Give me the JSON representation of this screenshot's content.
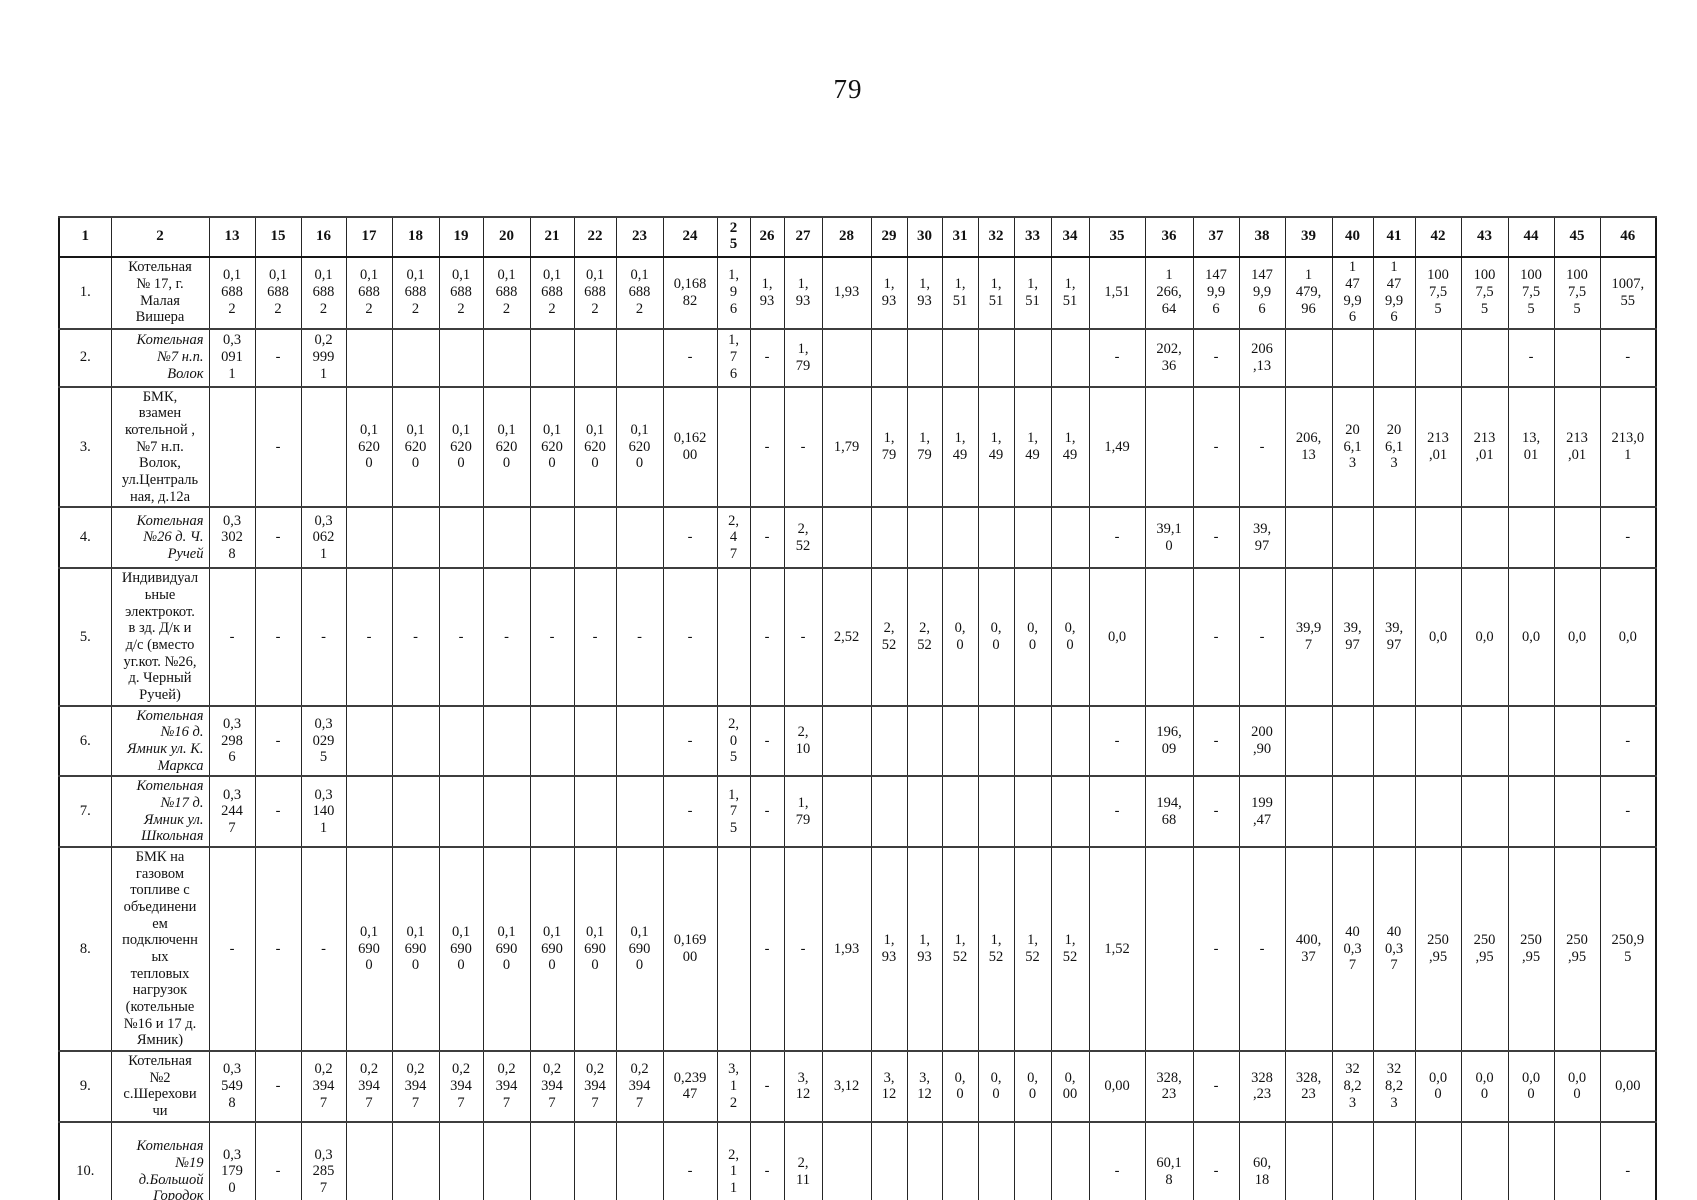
{
  "page": {
    "number": "79"
  },
  "table": {
    "header": [
      "1",
      "2",
      "13",
      "15",
      "16",
      "17",
      "18",
      "19",
      "20",
      "21",
      "22",
      "23",
      "24",
      "2\n5",
      "26",
      "27",
      "28",
      "29",
      "30",
      "31",
      "32",
      "33",
      "34",
      "35",
      "36",
      "37",
      "38",
      "39",
      "40",
      "41",
      "42",
      "43",
      "44",
      "45",
      "46"
    ],
    "rows": [
      {
        "num": "1.",
        "italic": false,
        "name": "Котельная\n№ 17, г.\nМалая\nВишера",
        "values": {
          "13": "0,1\n688\n2",
          "15": "0,1\n688\n2",
          "16": "0,1\n688\n2",
          "17": "0,1\n688\n2",
          "18": "0,1\n688\n2",
          "19": "0,1\n688\n2",
          "20": "0,1\n688\n2",
          "21": "0,1\n688\n2",
          "22": "0,1\n688\n2",
          "23": "0,1\n688\n2",
          "24": "0,168\n82",
          "25": "1,\n9\n6",
          "26": "1,\n93",
          "27": "1,\n93",
          "28": "1,93",
          "29": "1,\n93",
          "30": "1,\n93",
          "31": "1,\n51",
          "32": "1,\n51",
          "33": "1,\n51",
          "34": "1,\n51",
          "35": "1,51",
          "36": "1\n266,\n64",
          "37": "147\n9,9\n6",
          "38": "147\n9,9\n6",
          "39": "1\n479,\n96",
          "40": "1\n47\n9,9\n6",
          "41": "1\n47\n9,9\n6",
          "42": "100\n7,5\n5",
          "43": "100\n7,5\n5",
          "44": "100\n7,5\n5",
          "45": "100\n7,5\n5",
          "46": "1007,\n55"
        }
      },
      {
        "num": "2.",
        "italic": true,
        "name": "Котельная\n№7   н.п.\nВолок",
        "values": {
          "13": "0,3\n091\n1",
          "15": "-",
          "16": "0,2\n999\n1",
          "24": "-",
          "25": "1,\n7\n6",
          "26": "-",
          "27": "1,\n79",
          "35": "-",
          "36": "202,\n36",
          "37": "-",
          "38": "206\n,13",
          "44": "-",
          "46": "-"
        }
      },
      {
        "num": "3.",
        "italic": false,
        "name": "БМК,\nвзамен\nкотельной ,\n№7 н.п.\nВолок,\nул.Централь\nная, д.12а",
        "values": {
          "15": "-",
          "17": "0,1\n620\n0",
          "18": "0,1\n620\n0",
          "19": "0,1\n620\n0",
          "20": "0,1\n620\n0",
          "21": "0,1\n620\n0",
          "22": "0,1\n620\n0",
          "23": "0,1\n620\n0",
          "24": "0,162\n00",
          "26": "-",
          "27": "-",
          "28": "1,79",
          "29": "1,\n79",
          "30": "1,\n79",
          "31": "1,\n49",
          "32": "1,\n49",
          "33": "1,\n49",
          "34": "1,\n49",
          "35": "1,49",
          "37": "-",
          "38": "-",
          "39": "206,\n13",
          "40": "20\n6,1\n3",
          "41": "20\n6,1\n3",
          "42": "213\n,01",
          "43": "213\n,01",
          "44": "13,\n01",
          "45": "213\n,01",
          "46": "213,0\n1"
        }
      },
      {
        "num": "4.",
        "italic": true,
        "name": "Котельная\n№26 д. Ч.\nРучей",
        "values": {
          "13": "0,3\n302\n8",
          "15": "-",
          "16": "0,3\n062\n1",
          "24": "-",
          "25": "2,\n4\n7",
          "26": "-",
          "27": "2,\n52",
          "35": "-",
          "36": "39,1\n0",
          "37": "-",
          "38": "39,\n97",
          "46": "-"
        }
      },
      {
        "num": "5.",
        "italic": false,
        "name": "Индивидуал\nьные\nэлектрокот.\nв зд. Д/к и\nд/с (вместо\nуг.кот. №26,\nд. Черный\nРучей)",
        "values": {
          "13": "-",
          "15": "-",
          "16": "-",
          "17": "-",
          "18": "-",
          "19": "-",
          "20": "-",
          "21": "-",
          "22": "-",
          "23": "-",
          "24": "-",
          "26": "-",
          "27": "-",
          "28": "2,52",
          "29": "2,\n52",
          "30": "2,\n52",
          "31": "0,\n0",
          "32": "0,\n0",
          "33": "0,\n0",
          "34": "0,\n0",
          "35": "0,0",
          "37": "-",
          "38": "-",
          "39": "39,9\n7",
          "40": "39,\n97",
          "41": "39,\n97",
          "42": "0,0",
          "43": "0,0",
          "44": "0,0",
          "45": "0,0",
          "46": "0,0"
        }
      },
      {
        "num": "6.",
        "italic": true,
        "name": "Котельная\n№16 д.\nЯмник ул. К.\nМаркса",
        "values": {
          "13": "0,3\n298\n6",
          "15": "-",
          "16": "0,3\n029\n5",
          "24": "-",
          "25": "2,\n0\n5",
          "26": "-",
          "27": "2,\n10",
          "35": "-",
          "36": "196,\n09",
          "37": "-",
          "38": "200\n,90",
          "46": "-"
        }
      },
      {
        "num": "7.",
        "italic": true,
        "name": "Котельная\n№17 д.\nЯмник ул.\nШкольная",
        "values": {
          "13": "0,3\n244\n7",
          "15": "-",
          "16": "0,3\n140\n1",
          "24": "-",
          "25": "1,\n7\n5",
          "26": "-",
          "27": "1,\n79",
          "35": "-",
          "36": "194,\n68",
          "37": "-",
          "38": "199\n,47",
          "46": "-"
        }
      },
      {
        "num": "8.",
        "italic": false,
        "name": "БМК на\nгазовом\nтопливе с\nобъединени\nем\nподключенн\nых\nтепловых\nнагрузок\n(котельные\n№16 и 17 д.\nЯмник)",
        "values": {
          "13": "-",
          "15": "-",
          "16": "-",
          "17": "0,1\n690\n0",
          "18": "0,1\n690\n0",
          "19": "0,1\n690\n0",
          "20": "0,1\n690\n0",
          "21": "0,1\n690\n0",
          "22": "0,1\n690\n0",
          "23": "0,1\n690\n0",
          "24": "0,169\n00",
          "26": "-",
          "27": "-",
          "28": "1,93",
          "29": "1,\n93",
          "30": "1,\n93",
          "31": "1,\n52",
          "32": "1,\n52",
          "33": "1,\n52",
          "34": "1,\n52",
          "35": "1,52",
          "37": "-",
          "38": "-",
          "39": "400,\n37",
          "40": "40\n0,3\n7",
          "41": "40\n0,3\n7",
          "42": "250\n,95",
          "43": "250\n,95",
          "44": "250\n,95",
          "45": "250\n,95",
          "46": "250,9\n5"
        }
      },
      {
        "num": "9.",
        "italic": false,
        "name": "Котельная\n№2\nс.Шерехови\nчи",
        "values": {
          "13": "0,3\n549\n8",
          "15": "-",
          "16": "0,2\n394\n7",
          "17": "0,2\n394\n7",
          "18": "0,2\n394\n7",
          "19": "0,2\n394\n7",
          "20": "0,2\n394\n7",
          "21": "0,2\n394\n7",
          "22": "0,2\n394\n7",
          "23": "0,2\n394\n7",
          "24": "0,239\n47",
          "25": "3,\n1\n2",
          "26": "-",
          "27": "3,\n12",
          "28": "3,12",
          "29": "3,\n12",
          "30": "3,\n12",
          "31": "0,\n0",
          "32": "0,\n0",
          "33": "0,\n0",
          "34": "0,\n00",
          "35": "0,00",
          "36": "328,\n23",
          "37": "-",
          "38": "328\n,23",
          "39": "328,\n23",
          "40": "32\n8,2\n3",
          "41": "32\n8,2\n3",
          "42": "0,0\n0",
          "43": "0,0\n0",
          "44": "0,0\n0",
          "45": "0,0\n0",
          "46": "0,00"
        }
      },
      {
        "num": "10.",
        "italic": true,
        "name": "Котельная\n№19\nд.Большой\nГородок",
        "values": {
          "13": "0,3\n179\n0",
          "15": "-",
          "16": "0,3\n285\n7",
          "24": "-",
          "25": "2,\n1\n1",
          "26": "-",
          "27": "2,\n11",
          "35": "-",
          "36": "60,1\n8",
          "37": "-",
          "38": "60,\n18",
          "46": "-"
        }
      }
    ]
  }
}
